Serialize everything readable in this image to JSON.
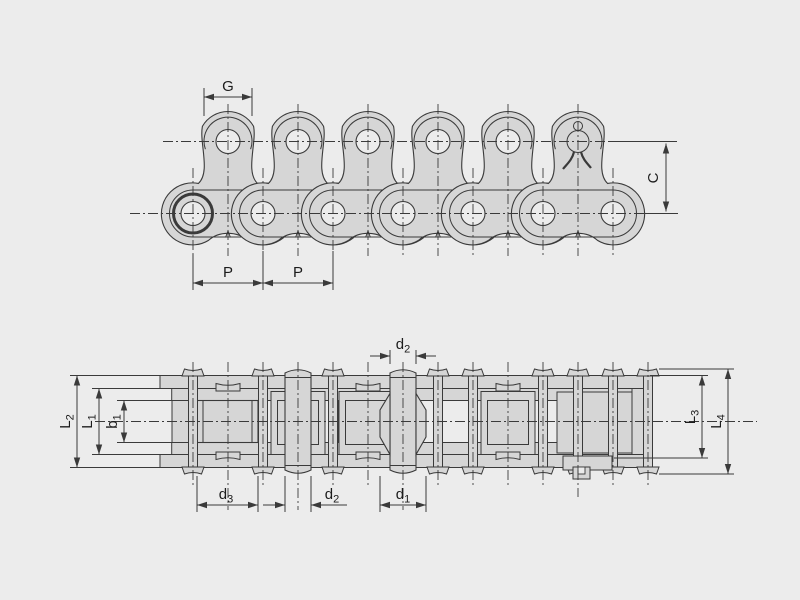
{
  "drawing": {
    "type": "roller chain technical drawing",
    "colors": {
      "background": "#ececec",
      "part_fill": "#d6d6d6",
      "line": "#3a3a3a",
      "text": "#1c1c1c"
    },
    "top_view": {
      "dim_g": "G",
      "dim_p_left": "P",
      "dim_p_right": "P",
      "dim_c": "C"
    },
    "bottom_view": {
      "dim_l2": {
        "main": "L",
        "sub": "2"
      },
      "dim_l1": {
        "main": "L",
        "sub": "1"
      },
      "dim_b1": {
        "main": "b",
        "sub": "1"
      },
      "dim_l3": {
        "main": "L",
        "sub": "3"
      },
      "dim_l4": {
        "main": "L",
        "sub": "4"
      },
      "dim_d2_top": {
        "main": "d",
        "sub": "2"
      },
      "dim_d3": {
        "main": "d",
        "sub": "3"
      },
      "dim_d2_bottom": {
        "main": "d",
        "sub": "2"
      },
      "dim_d1": {
        "main": "d",
        "sub": "1"
      }
    }
  }
}
